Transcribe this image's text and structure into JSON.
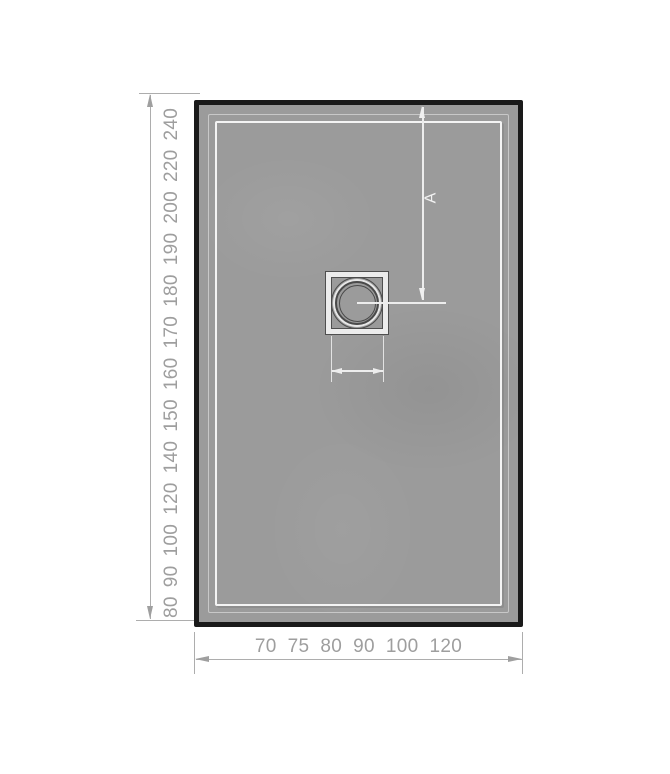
{
  "left_scale": {
    "values": [
      "80",
      "90",
      "100",
      "120",
      "140",
      "150",
      "160",
      "170",
      "180",
      "190",
      "200",
      "220",
      "240"
    ]
  },
  "bottom_scale": {
    "values": [
      "70",
      "75",
      "80",
      "90",
      "100",
      "120"
    ]
  },
  "tray": {
    "dimension_label": "A"
  },
  "colors": {
    "background": "#ffffff",
    "tray_fill": "#9b9b9b",
    "tray_border": "#1a1a1a",
    "tray_rim_line": "#f0f0f0",
    "drain_outline": "#4a4a4a",
    "dimension_line_gray": "#adadad",
    "dimension_line_white": "#ededed",
    "scale_text": "#9e9e9e"
  },
  "icons": {
    "dimension_arrowheads": "thin triangle arrows at line ends (up, down, left, right)"
  }
}
